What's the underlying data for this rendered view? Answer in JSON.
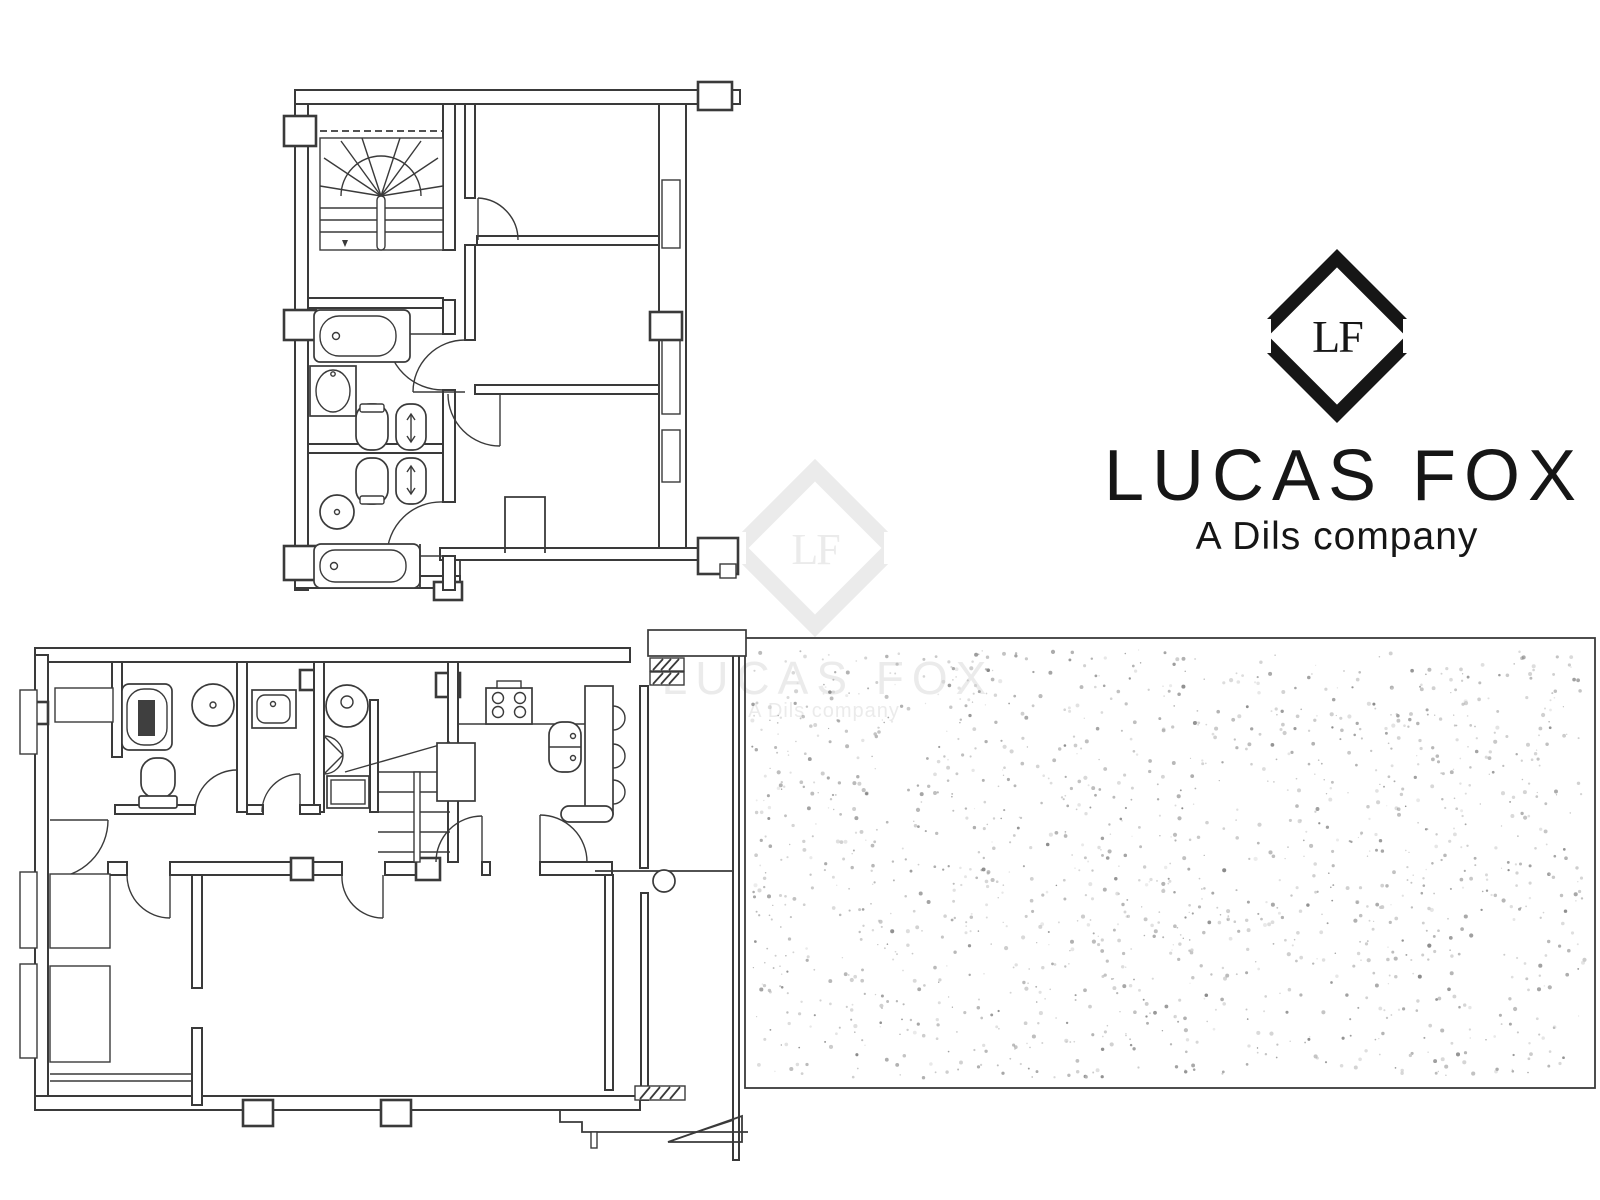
{
  "page": {
    "background_color": "#ffffff",
    "ink_color": "#3a3a3a"
  },
  "branding": {
    "monogram": "LF",
    "company_name": "LUCAS FOX",
    "tagline": "A Dils company",
    "text_color": "#161616"
  },
  "watermark": {
    "monogram": "LF",
    "company_name": "LUCAS FOX",
    "tagline": "A Dils company",
    "color": "#ebebeb"
  },
  "floorplan": {
    "upper_floor": {
      "label": "upper floor plan",
      "fixtures": [
        "staircase",
        "bathtub",
        "washbasin",
        "toilet",
        "bidet",
        "toilet",
        "bidet",
        "round-washbasin",
        "bathtub",
        "doors",
        "closet"
      ]
    },
    "lower_floor": {
      "label": "lower floor plan",
      "fixtures": [
        "bathtub",
        "toilet",
        "pedestal-washbasin",
        "counter-washbasin",
        "washing-machine",
        "staircase",
        "hob",
        "kitchen-sink",
        "breakfast-bar",
        "stools",
        "column",
        "wardrobe",
        "doors"
      ]
    },
    "terrace": {
      "label": "terrace",
      "stipple_colors": [
        "#858585",
        "#9a9a9a",
        "#b3b3b3",
        "#c9c9c9"
      ],
      "dot_count": 1500
    }
  }
}
